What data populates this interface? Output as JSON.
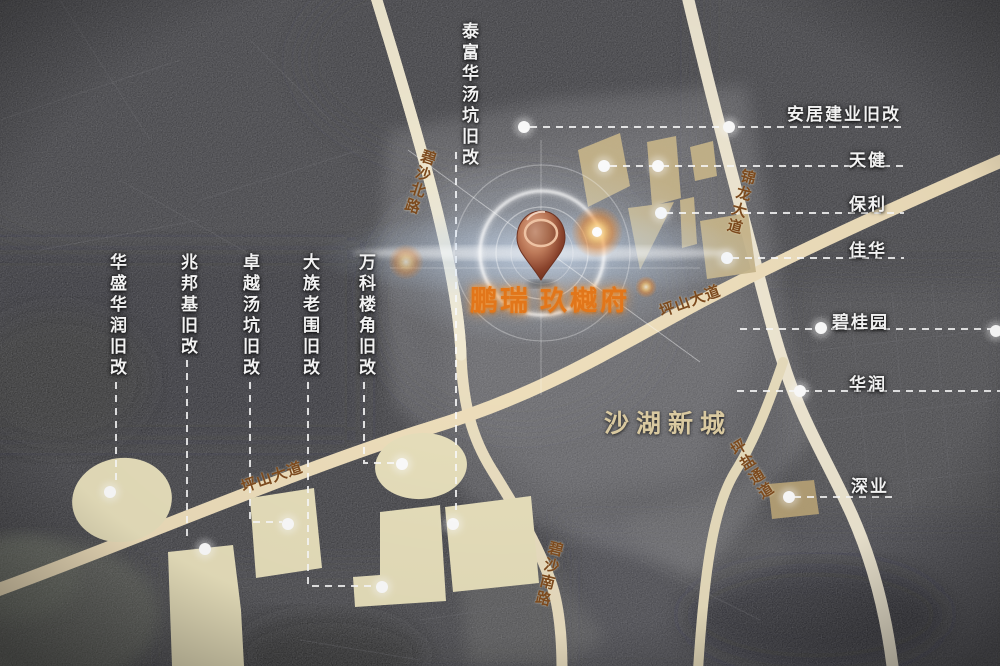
{
  "project": {
    "brand": "鹏瑞",
    "name": "玖樾府"
  },
  "area_label": "沙湖新城",
  "labels": {
    "top": "泰富华汤坑旧改",
    "left": [
      "华盛华润旧改",
      "兆邦基旧改",
      "卓越汤坑旧改",
      "大族老围旧改",
      "万科楼角旧改"
    ],
    "right": [
      "安居建业旧改",
      "天健",
      "保利",
      "佳华",
      "碧桂园",
      "华润",
      "深业"
    ]
  },
  "roads": [
    "碧沙北路",
    "锦龙大道",
    "坪山大道",
    "坪山大道",
    "碧沙南路",
    "坪盐通道"
  ],
  "colors": {
    "background": "#232327",
    "road": "#f0e4c4",
    "parcel_cream": "#e9e1bd",
    "parcel_tan": "#c9b78c",
    "accent_orange": "#e2761a",
    "area_text": "#d9c9a0",
    "label_text": "#f2f2f2",
    "road_text": "#7c4a1e",
    "pin_copper": "#a0522d"
  }
}
